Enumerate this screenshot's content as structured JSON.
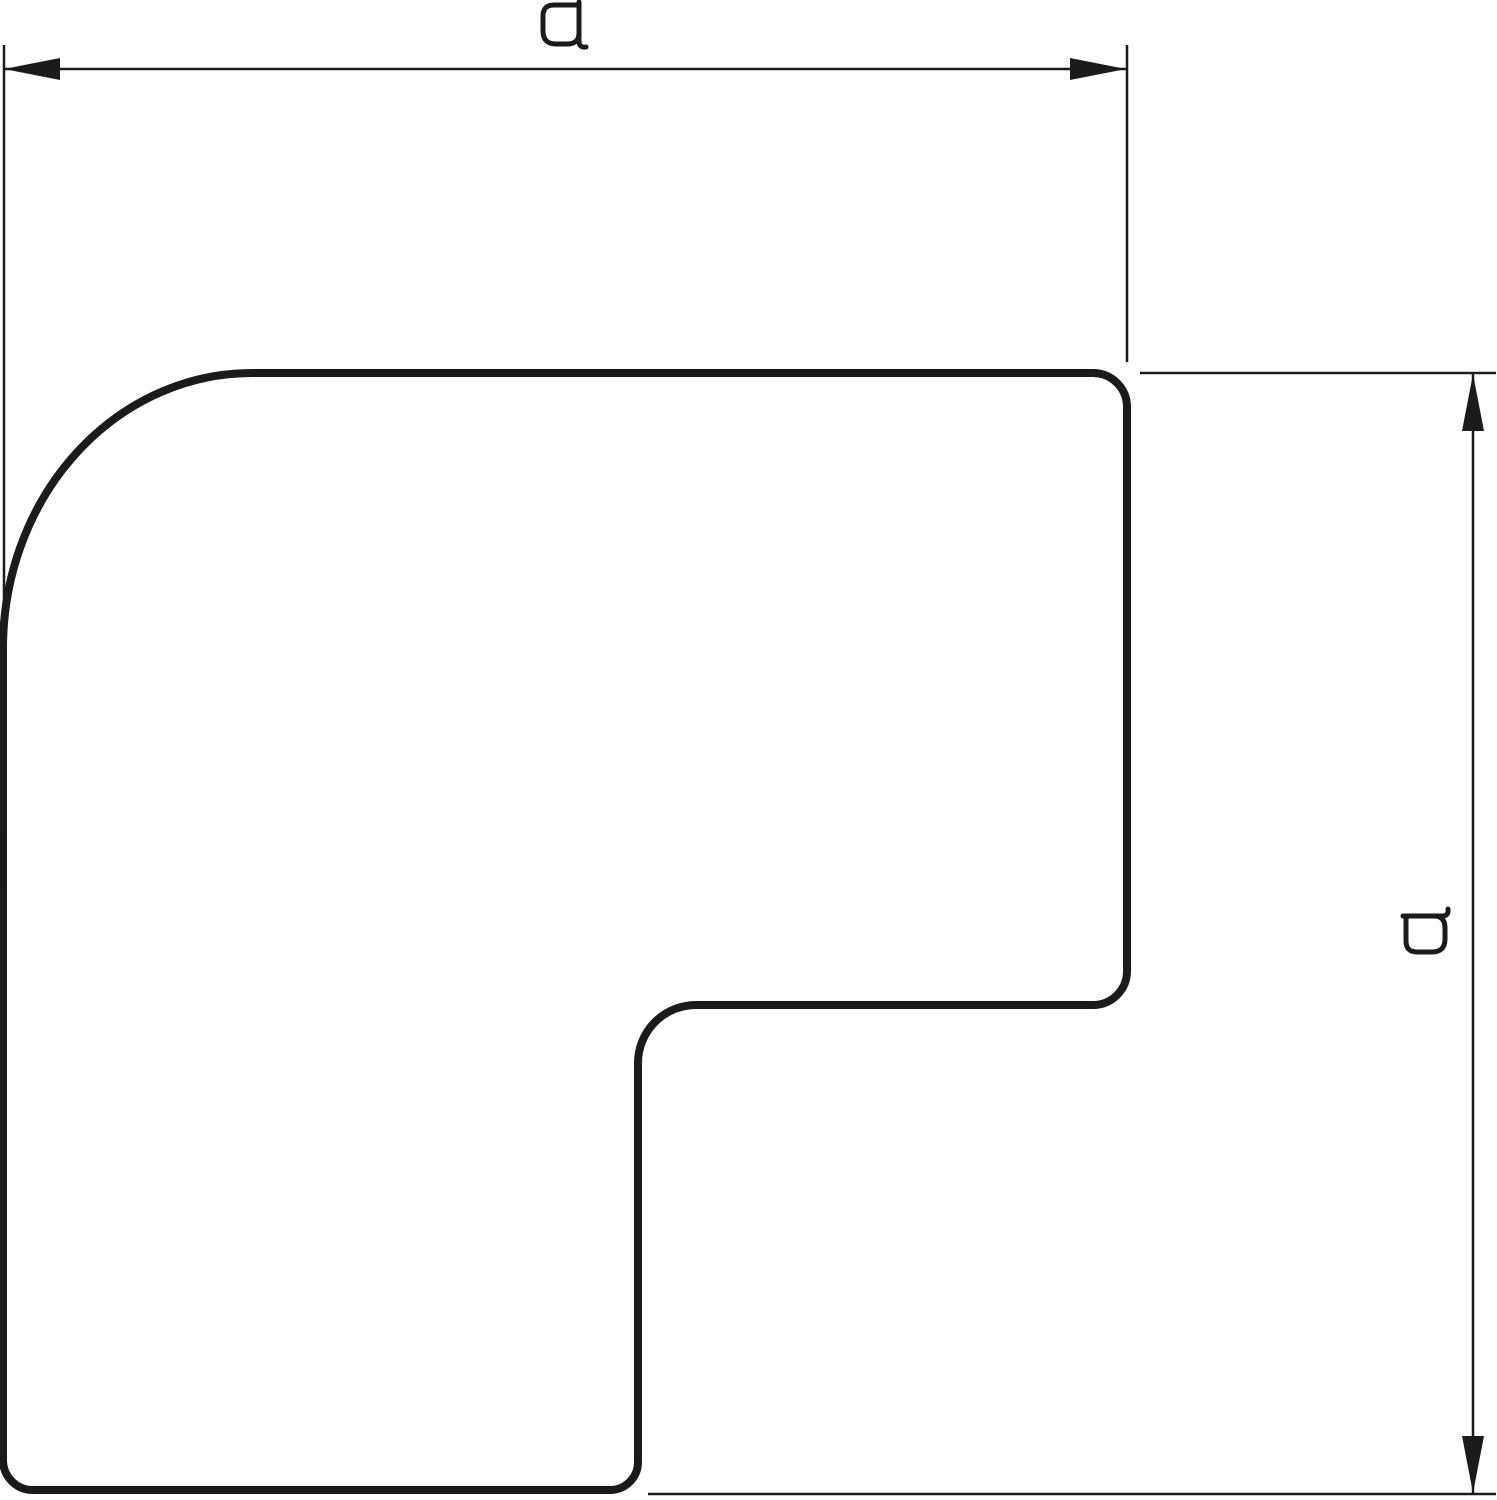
{
  "drawing": {
    "background_color": "#ffffff",
    "line_color": "#1b1b1b"
  },
  "dimensions": {
    "horizontal": {
      "label": "a"
    },
    "vertical": {
      "label": "a"
    }
  }
}
